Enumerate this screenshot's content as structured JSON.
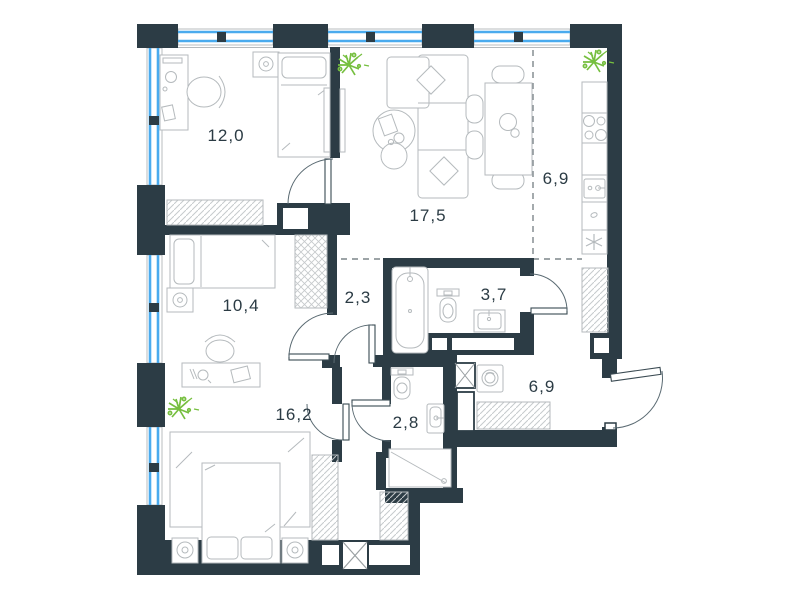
{
  "plan": {
    "type": "apartment-floor-plan",
    "rooms": [
      {
        "id": "bedroom-1",
        "label": "12,0",
        "features": [
          "desk",
          "desk-chair",
          "single-bed",
          "nightstand",
          "wardrobe"
        ]
      },
      {
        "id": "living-room",
        "label": "17,5",
        "features": [
          "corner-sofa",
          "pillows",
          "coffee-table",
          "dining-table",
          "chairs",
          "tv-panel",
          "plant"
        ]
      },
      {
        "id": "kitchen",
        "label": "6,9",
        "features": [
          "counter",
          "stove",
          "kitchen-sink",
          "fridge",
          "plant"
        ]
      },
      {
        "id": "bedroom-2",
        "label": "10,4",
        "features": [
          "single-bed",
          "nightstand",
          "desk",
          "desk-chair",
          "wardrobe"
        ]
      },
      {
        "id": "corridor",
        "label": "2,3",
        "features": [
          "doors"
        ]
      },
      {
        "id": "bathroom",
        "label": "3,7",
        "features": [
          "bathtub",
          "toilet",
          "sink"
        ]
      },
      {
        "id": "hallway",
        "label": "6,9",
        "features": [
          "washing-machine",
          "shaft",
          "wardrobe",
          "entry-door"
        ]
      },
      {
        "id": "bedroom-3",
        "label": "16,2",
        "features": [
          "double-bed",
          "carpet",
          "nightstands",
          "lamps",
          "wardrobes",
          "plant"
        ]
      },
      {
        "id": "shower-room",
        "label": "2,8",
        "features": [
          "toilet",
          "sink",
          "shower-tray"
        ]
      }
    ],
    "colors": {
      "wall": "#2c3c45",
      "window": "#4aabee",
      "furniture_line": "#b5babd",
      "hatch_line": "#c6cacc",
      "plant": "#76bf3f",
      "label_text": "#2b3b44",
      "background": "#ffffff"
    },
    "icons": [
      "plant-icon",
      "bed-icon",
      "sofa-icon",
      "pillow-icon",
      "coffee-table-icon",
      "dining-table-icon",
      "chair-icon",
      "desk-icon",
      "bathtub-icon",
      "toilet-icon",
      "sink-icon",
      "shower-icon",
      "washing-machine-icon",
      "stove-icon",
      "fridge-snowflake-icon",
      "wardrobe-hatch-icon",
      "door-arc-icon",
      "ventilation-shaft-icon",
      "window-band-icon"
    ]
  }
}
